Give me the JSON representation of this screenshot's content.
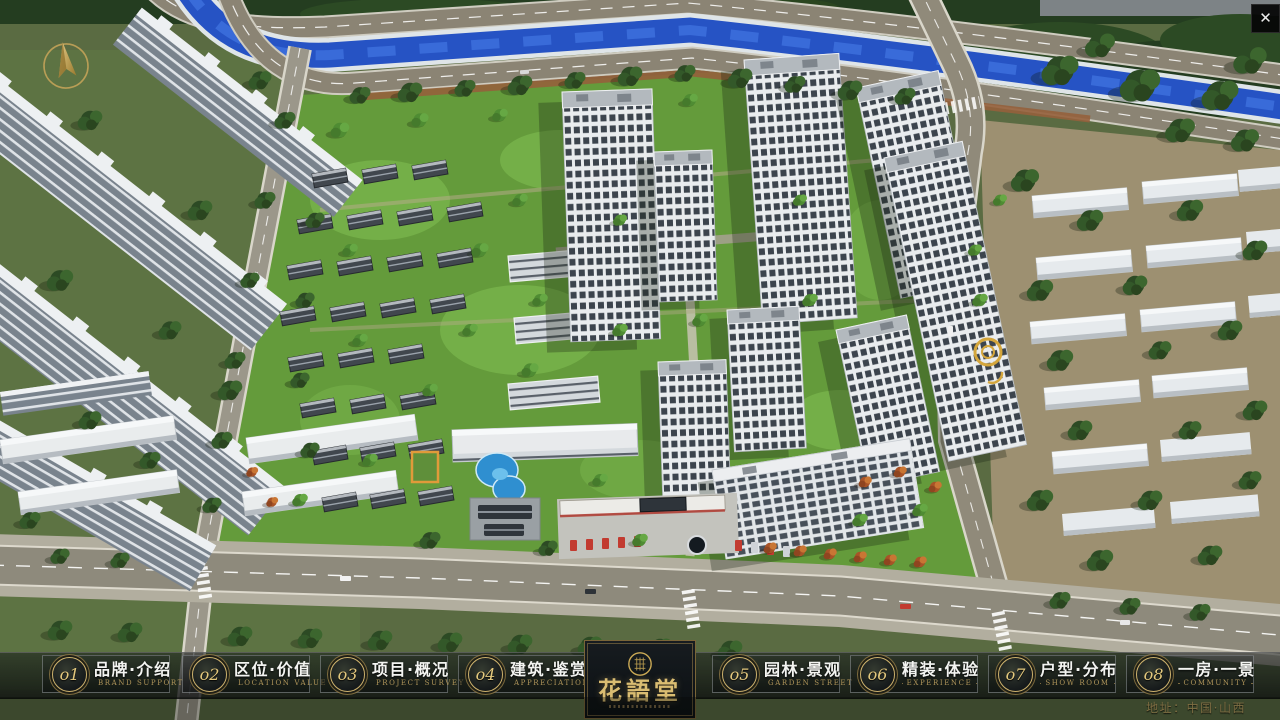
{
  "window": {
    "close_icon": "✕"
  },
  "nav": {
    "items": [
      {
        "num": "o1",
        "label": "品牌·介绍",
        "sub": "BRAND SUPPORT"
      },
      {
        "num": "o2",
        "label": "区位·价值",
        "sub": "LOCATION VALUE"
      },
      {
        "num": "o3",
        "label": "项目·概况",
        "sub": "PROJECT SURVEY"
      },
      {
        "num": "o4",
        "label": "建筑·鉴赏",
        "sub": "APPRECIATION"
      },
      {
        "num": "o5",
        "label": "园林·景观",
        "sub": "GARDEN STREET"
      },
      {
        "num": "o6",
        "label": "精装·体验",
        "sub": "EXPERIENCE"
      },
      {
        "num": "o7",
        "label": "户型·分布",
        "sub": "SHOW ROOM"
      },
      {
        "num": "o8",
        "label": "一房·一景",
        "sub": "COMMUNITY"
      }
    ],
    "logo": {
      "title": "花語堂"
    },
    "address": "地址：中国·山西"
  },
  "colors": {
    "gold_accent": "#cdb26d",
    "bar_background": "rgba(12,15,17,0.65)",
    "river_blue": "#2653c4",
    "lawn_green": "#67a03c"
  }
}
